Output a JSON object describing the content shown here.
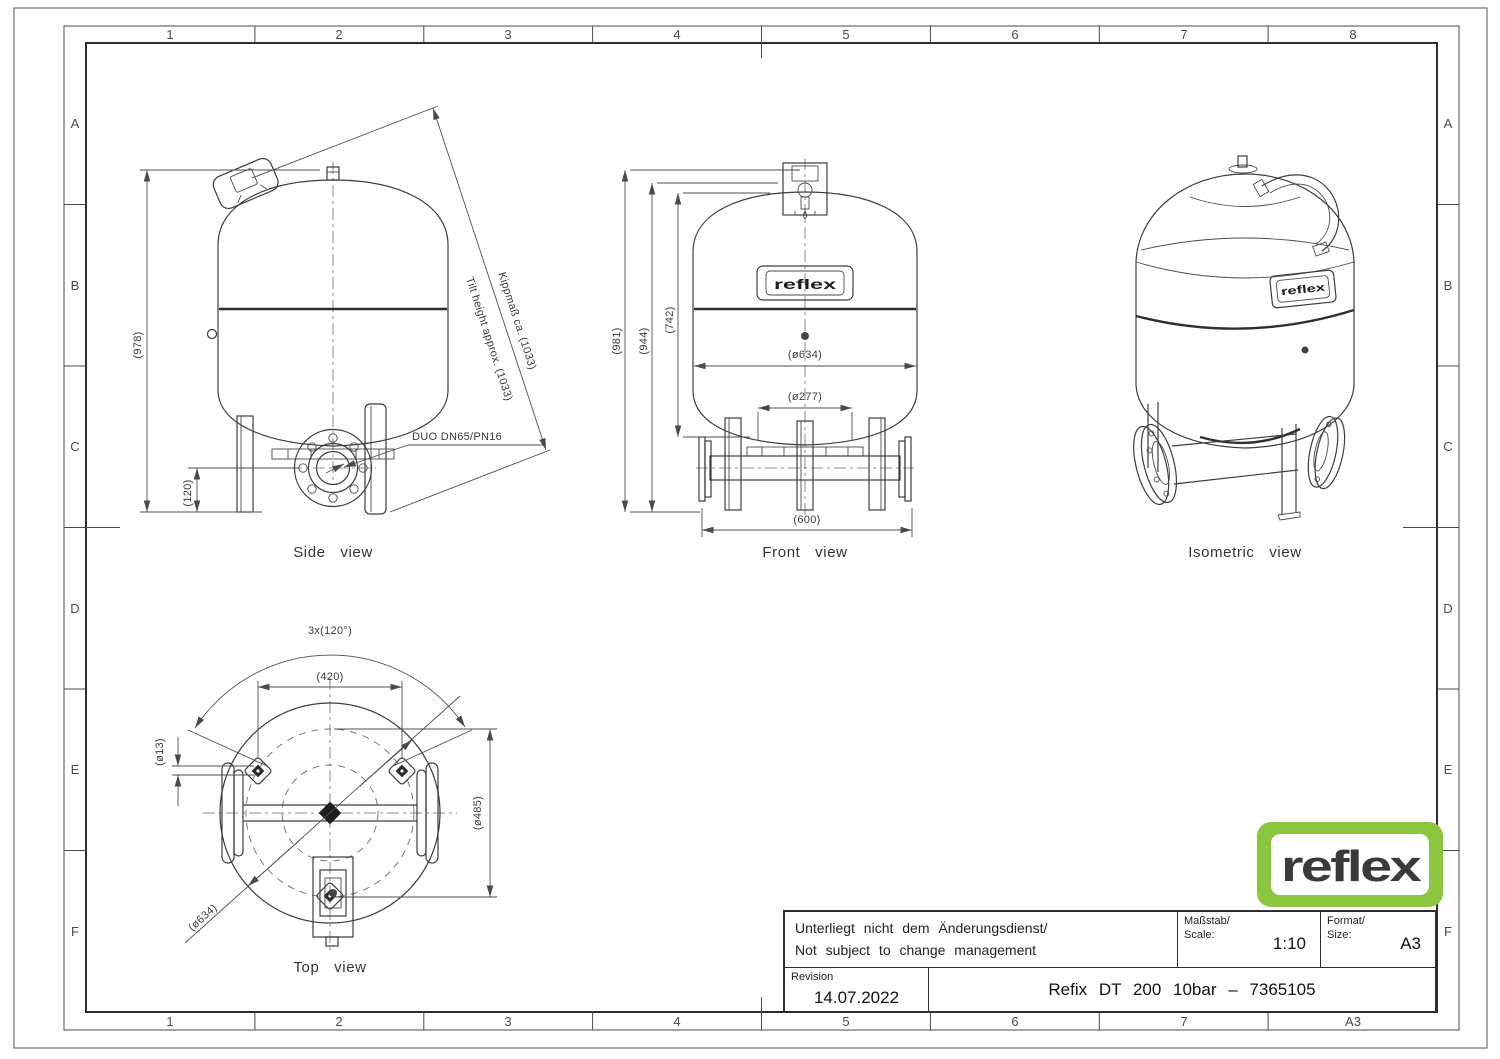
{
  "frame": {
    "top_labels": [
      "1",
      "2",
      "3",
      "4",
      "5",
      "6",
      "7",
      "8"
    ],
    "bottom_labels": [
      "1",
      "2",
      "3",
      "4",
      "5",
      "6",
      "7",
      "A3"
    ],
    "side_labels": [
      "A",
      "B",
      "C",
      "D",
      "E",
      "F"
    ]
  },
  "views": {
    "side": {
      "caption": "Side view",
      "dims": {
        "height": "(978)",
        "port_height": "(120)",
        "tilt_de": "Kippmaß ca. (1033)",
        "tilt_en": "Tilt height approx. (1033)",
        "connection": "DUO DN65/PN16"
      }
    },
    "front": {
      "caption": "Front view",
      "dims": {
        "total_height": "(981)",
        "vessel_height": "(944)",
        "body_height": "(742)",
        "diameter": "(ø634)",
        "inner_diameter": "(ø277)",
        "base_width": "(600)"
      }
    },
    "isometric": {
      "caption": "Isometric view"
    },
    "top": {
      "caption": "Top view",
      "dims": {
        "leg_angle": "3x(120°)",
        "leg_spacing": "(420)",
        "hole": "(ø13)",
        "diameter": "(ø634)",
        "leg_circle": "(ø485)"
      }
    }
  },
  "nameplate": "reflex",
  "logo": {
    "text": "reflex"
  },
  "colors": {
    "logo_green": "#8cc63f",
    "line": "#3c3c3c"
  },
  "title_block": {
    "note_line1": "Unterliegt nicht dem Änderungsdienst/",
    "note_line2": "Not subject to change management",
    "scale_label": "Maßstab/",
    "scale_label2": "Scale:",
    "scale_value": "1:10",
    "format_label": "Format/",
    "format_label2": "Size:",
    "format_value": "A3",
    "revision_label": "Revision",
    "revision_value": "14.07.2022",
    "title": "Refix DT 200 10bar – 7365105"
  }
}
